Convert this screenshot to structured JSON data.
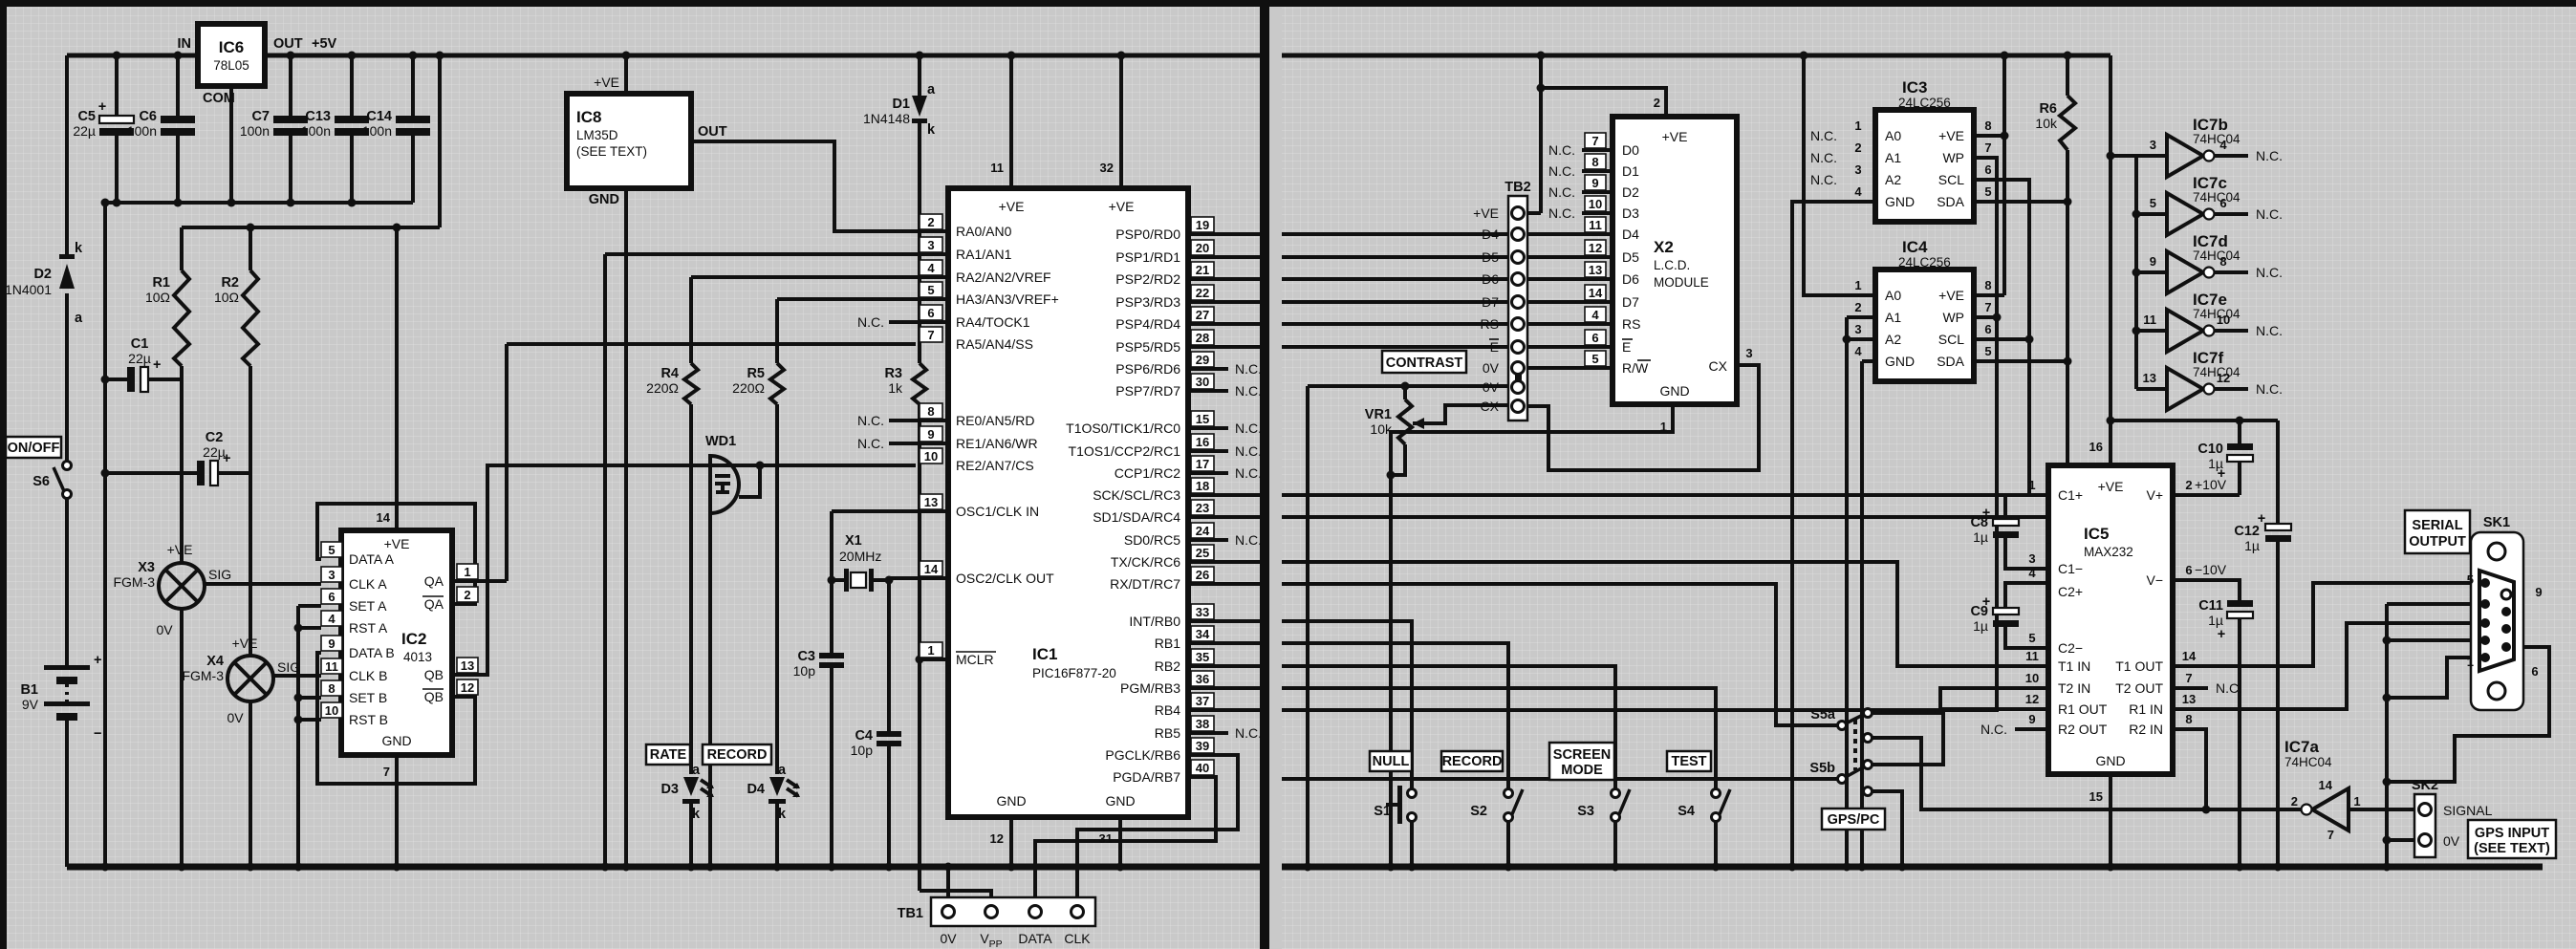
{
  "t": {
    "nc": "N.C.",
    "ve": "+VE",
    "gnd": "GND",
    "zv": "0V",
    "sig": "SIG",
    "a": "a",
    "k": "k",
    "plus": "+",
    "minus": "−",
    "p5v": "+5V",
    "in": "IN",
    "out": "OUT",
    "com": "COM",
    "data": "DATA",
    "clk": "CLK",
    "v": "V",
    "pp": "PP",
    "p10": "+10V",
    "m10": "−10V"
  },
  "ic6": {
    "ref": "IC6",
    "part": "78L05"
  },
  "ic8": {
    "ref": "IC8",
    "part": "LM35D",
    "note": "(SEE TEXT)"
  },
  "ic1": {
    "ref": "IC1",
    "part": "PIC16F877-20",
    "n11": "11",
    "n32": "32",
    "n12": "12",
    "n31": "31",
    "left": [
      {
        "n": "2",
        "l": "RA0/AN0"
      },
      {
        "n": "3",
        "l": "RA1/AN1"
      },
      {
        "n": "4",
        "l": "RA2/AN2/VREF"
      },
      {
        "n": "5",
        "l": "HA3/AN3/VREF+"
      },
      {
        "n": "6",
        "l": "RA4/TOCK1"
      },
      {
        "n": "7",
        "l": "RA5/AN4/SS"
      },
      {
        "n": "8",
        "l": "RE0/AN5/RD"
      },
      {
        "n": "9",
        "l": "RE1/AN6/WR"
      },
      {
        "n": "10",
        "l": "RE2/AN7/CS"
      },
      {
        "n": "13",
        "l": "OSC1/CLK IN"
      },
      {
        "n": "14",
        "l": "OSC2/CLK OUT"
      },
      {
        "n": "1",
        "l": "MCLR"
      }
    ],
    "right": [
      {
        "n": "19",
        "l": "PSP0/RD0"
      },
      {
        "n": "20",
        "l": "PSP1/RD1"
      },
      {
        "n": "21",
        "l": "PSP2/RD2"
      },
      {
        "n": "22",
        "l": "PSP3/RD3"
      },
      {
        "n": "27",
        "l": "PSP4/RD4"
      },
      {
        "n": "28",
        "l": "PSP5/RD5"
      },
      {
        "n": "29",
        "l": "PSP6/RD6"
      },
      {
        "n": "30",
        "l": "PSP7/RD7"
      },
      {
        "n": "15",
        "l": "T1OS0/TICK1/RC0"
      },
      {
        "n": "16",
        "l": "T1OS1/CCP2/RC1"
      },
      {
        "n": "17",
        "l": "CCP1/RC2"
      },
      {
        "n": "18",
        "l": "SCK/SCL/RC3"
      },
      {
        "n": "23",
        "l": "SD1/SDA/RC4"
      },
      {
        "n": "24",
        "l": "SD0/RC5"
      },
      {
        "n": "25",
        "l": "TX/CK/RC6"
      },
      {
        "n": "26",
        "l": "RX/DT/RC7"
      },
      {
        "n": "33",
        "l": "INT/RB0"
      },
      {
        "n": "34",
        "l": "RB1"
      },
      {
        "n": "35",
        "l": "RB2"
      },
      {
        "n": "36",
        "l": "PGM/RB3"
      },
      {
        "n": "37",
        "l": "RB4"
      },
      {
        "n": "38",
        "l": "RB5"
      },
      {
        "n": "39",
        "l": "PGCLK/RB6"
      },
      {
        "n": "40",
        "l": "PGDA/RB7"
      }
    ]
  },
  "ic2": {
    "ref": "IC2",
    "part": "4013",
    "n14": "14",
    "n7": "7",
    "left": [
      {
        "n": "5",
        "l": "DATA A"
      },
      {
        "n": "3",
        "l": "CLK A"
      },
      {
        "n": "6",
        "l": "SET A"
      },
      {
        "n": "4",
        "l": "RST A"
      },
      {
        "n": "9",
        "l": "DATA B"
      },
      {
        "n": "11",
        "l": "CLK B"
      },
      {
        "n": "8",
        "l": "SET B"
      },
      {
        "n": "10",
        "l": "RST B"
      }
    ],
    "right": [
      {
        "n": "1",
        "l": "QA"
      },
      {
        "n": "2",
        "l": "QA"
      },
      {
        "n": "13",
        "l": "QB"
      },
      {
        "n": "12",
        "l": "QB"
      }
    ]
  },
  "ee": {
    "left": [
      {
        "n": "1",
        "l": "A0"
      },
      {
        "n": "2",
        "l": "A1"
      },
      {
        "n": "3",
        "l": "A2"
      },
      {
        "n": "4",
        "l": "GND"
      }
    ],
    "right": [
      {
        "n": "8",
        "l": "+VE"
      },
      {
        "n": "7",
        "l": "WP"
      },
      {
        "n": "6",
        "l": "SCL"
      },
      {
        "n": "5",
        "l": "SDA"
      }
    ]
  },
  "ic3": {
    "ref": "IC3",
    "part": "24LC256"
  },
  "ic4": {
    "ref": "IC4",
    "part": "24LC256"
  },
  "ic5": {
    "ref": "IC5",
    "part": "MAX232",
    "n16": "16",
    "n15": "15",
    "left": [
      {
        "n": "1",
        "l": "C1+"
      },
      {
        "n": "3",
        "l": "C1−"
      },
      {
        "n": "4",
        "l": "C2+"
      },
      {
        "n": "5",
        "l": "C2−"
      },
      {
        "n": "11",
        "l": "T1 IN"
      },
      {
        "n": "10",
        "l": "T2 IN"
      },
      {
        "n": "12",
        "l": "R1 OUT"
      },
      {
        "n": "9",
        "l": "R2 OUT"
      }
    ],
    "right": [
      {
        "n": "2",
        "l": "V+"
      },
      {
        "n": "6",
        "l": "V−"
      },
      {
        "n": "14",
        "l": "T1 OUT"
      },
      {
        "n": "7",
        "l": "T2 OUT"
      },
      {
        "n": "13",
        "l": "R1 IN"
      },
      {
        "n": "8",
        "l": "R2 IN"
      }
    ]
  },
  "x2": {
    "ref": "X2",
    "l1": "L.C.D.",
    "l2": "MODULE",
    "n2": "2",
    "n1": "1",
    "cx": {
      "n": "3",
      "l": "CX"
    },
    "left": [
      {
        "n": "7",
        "l": "D0"
      },
      {
        "n": "8",
        "l": "D1"
      },
      {
        "n": "9",
        "l": "D2"
      },
      {
        "n": "10",
        "l": "D3"
      },
      {
        "n": "11",
        "l": "D4"
      },
      {
        "n": "12",
        "l": "D5"
      },
      {
        "n": "13",
        "l": "D6"
      },
      {
        "n": "14",
        "l": "D7"
      },
      {
        "n": "4",
        "l": "RS"
      },
      {
        "n": "6",
        "l": "E"
      },
      {
        "n": "5",
        "la": "R/",
        "lb": "W"
      }
    ]
  },
  "ic7": {
    "part": "74HC04",
    "a": {
      "ref": "IC7a",
      "nin": "1",
      "nout": "2",
      "nvcc": "14",
      "ngnd": "7"
    },
    "rows": [
      {
        "ref": "IC7b",
        "nin": "3",
        "nout": "4"
      },
      {
        "ref": "IC7c",
        "nin": "5",
        "nout": "6"
      },
      {
        "ref": "IC7d",
        "nin": "9",
        "nout": "8"
      },
      {
        "ref": "IC7e",
        "nin": "11",
        "nout": "10"
      },
      {
        "ref": "IC7f",
        "nin": "13",
        "nout": "12"
      }
    ]
  },
  "cmp": {
    "r1": {
      "r": "R1",
      "v": "10Ω"
    },
    "r2": {
      "r": "R2",
      "v": "10Ω"
    },
    "r3": {
      "r": "R3",
      "v": "1k"
    },
    "r4": {
      "r": "R4",
      "v": "220Ω"
    },
    "r5": {
      "r": "R5",
      "v": "220Ω"
    },
    "r6": {
      "r": "R6",
      "v": "10k"
    },
    "vr1": {
      "r": "VR1",
      "v": "10k"
    },
    "c1": {
      "r": "C1",
      "v": "22µ"
    },
    "c2": {
      "r": "C2",
      "v": "22µ"
    },
    "c3": {
      "r": "C3",
      "v": "10p"
    },
    "c4": {
      "r": "C4",
      "v": "10p"
    },
    "c5": {
      "r": "C5",
      "v": "22µ"
    },
    "c6": {
      "r": "C6",
      "v": "100n"
    },
    "c7": {
      "r": "C7",
      "v": "100n"
    },
    "c13": {
      "r": "C13",
      "v": "100n"
    },
    "c14": {
      "r": "C14",
      "v": "100n"
    },
    "c8": {
      "r": "C8",
      "v": "1µ"
    },
    "c9": {
      "r": "C9",
      "v": "1µ"
    },
    "c10": {
      "r": "C10",
      "v": "1µ"
    },
    "c11": {
      "r": "C11",
      "v": "1µ"
    },
    "c12": {
      "r": "C12",
      "v": "1µ"
    },
    "d1": {
      "r": "D1",
      "v": "1N4148"
    },
    "d2": {
      "r": "D2",
      "v": "1N4001"
    },
    "d3": {
      "r": "D3"
    },
    "d4": {
      "r": "D4"
    },
    "b1": {
      "r": "B1",
      "v": "9V"
    },
    "x1": {
      "r": "X1",
      "v": "20MHz"
    },
    "x3": {
      "r": "X3",
      "v": "FGM-3"
    },
    "x4": {
      "r": "X4",
      "v": "FGM-3"
    },
    "wd1": {
      "r": "WD1"
    }
  },
  "tb1": {
    "ref": "TB1",
    "zv": "0V",
    "data": "DATA",
    "clk": "CLK"
  },
  "tb2": {
    "ref": "TB2",
    "l": [
      "+VE",
      "D4",
      "D5",
      "D6",
      "D7",
      "RS",
      "E",
      "0V",
      "0V",
      "CX"
    ]
  },
  "sk1": {
    "ref": "SK1",
    "t1": "SERIAL",
    "t2": "OUTPUT",
    "p5": "5",
    "p1": "1",
    "p9": "9",
    "p6": "6"
  },
  "sk2": {
    "ref": "SK2",
    "sig": "SIGNAL",
    "zv": "0V",
    "b1": "GPS INPUT",
    "b2": "(SEE TEXT)"
  },
  "sw": {
    "s1": "S1",
    "s2": "S2",
    "s3": "S3",
    "s4": "S4",
    "s5a": "S5a",
    "s5b": "S5b",
    "s6": "S6",
    "nullb": "NULL",
    "record": "RECORD",
    "sm1": "SCREEN",
    "sm2": "MODE",
    "test": "TEST",
    "gpspc": "GPS/PC",
    "onoff": "ON/OFF"
  },
  "lbl": {
    "rate": "RATE",
    "record": "RECORD",
    "contrast": "CONTRAST"
  }
}
